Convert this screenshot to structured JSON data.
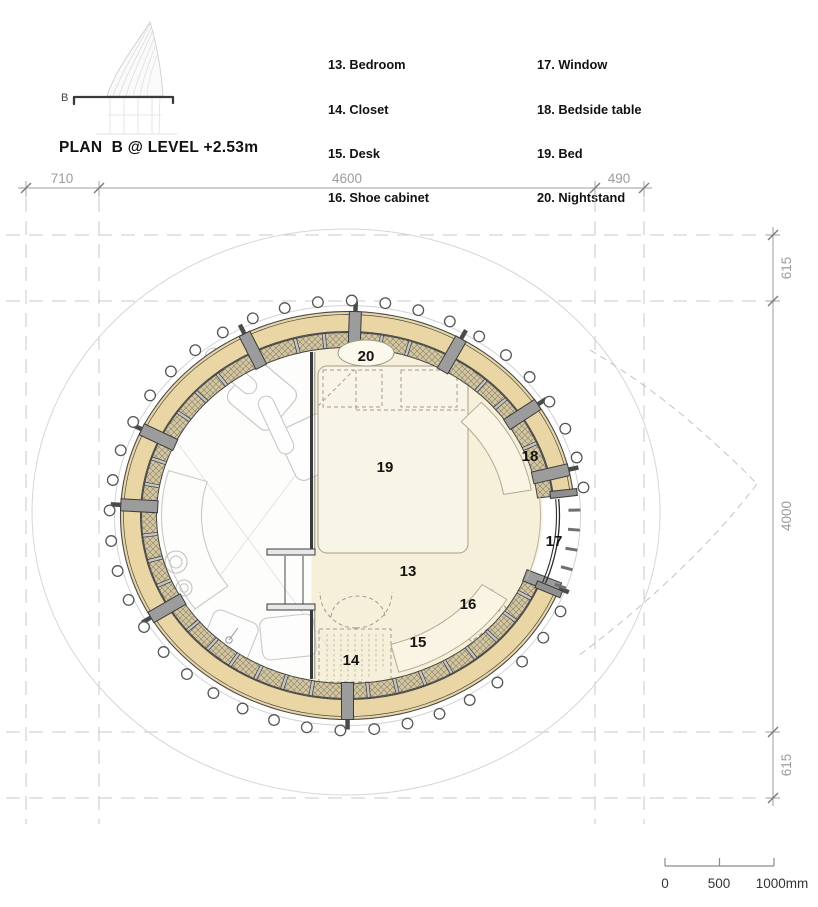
{
  "header": {
    "section_marker": "B",
    "title": "PLAN  B @ LEVEL +2.53m"
  },
  "legend": {
    "col1": [
      "13. Bedroom",
      "14. Closet",
      "15. Desk",
      "16. Shoe cabinet"
    ],
    "col2": [
      "17. Window",
      "18. Bedside table",
      "19. Bed",
      "20. Nightstand"
    ]
  },
  "dimensions": {
    "top": [
      "710",
      "4600",
      "490"
    ],
    "right": [
      "615",
      "4000",
      "615"
    ]
  },
  "plan": {
    "room_labels": {
      "r13": "13",
      "r14": "14",
      "r15": "15",
      "r16": "16",
      "r17": "17",
      "r18": "18",
      "r19": "19",
      "r20": "20"
    }
  },
  "scale_bar": {
    "labels": [
      "0",
      "500",
      "1000mm"
    ]
  },
  "colors": {
    "band_tan": "#e9d6a4",
    "hatch_base": "#d4c7a0",
    "hatch_line": "#857c69",
    "floor_cream": "#f6f0da",
    "floor_white": "#fdfdfc",
    "dark_line": "#3a3a3a",
    "dim_gray": "#9c9c9c",
    "light_gray": "#c9c9c9"
  }
}
